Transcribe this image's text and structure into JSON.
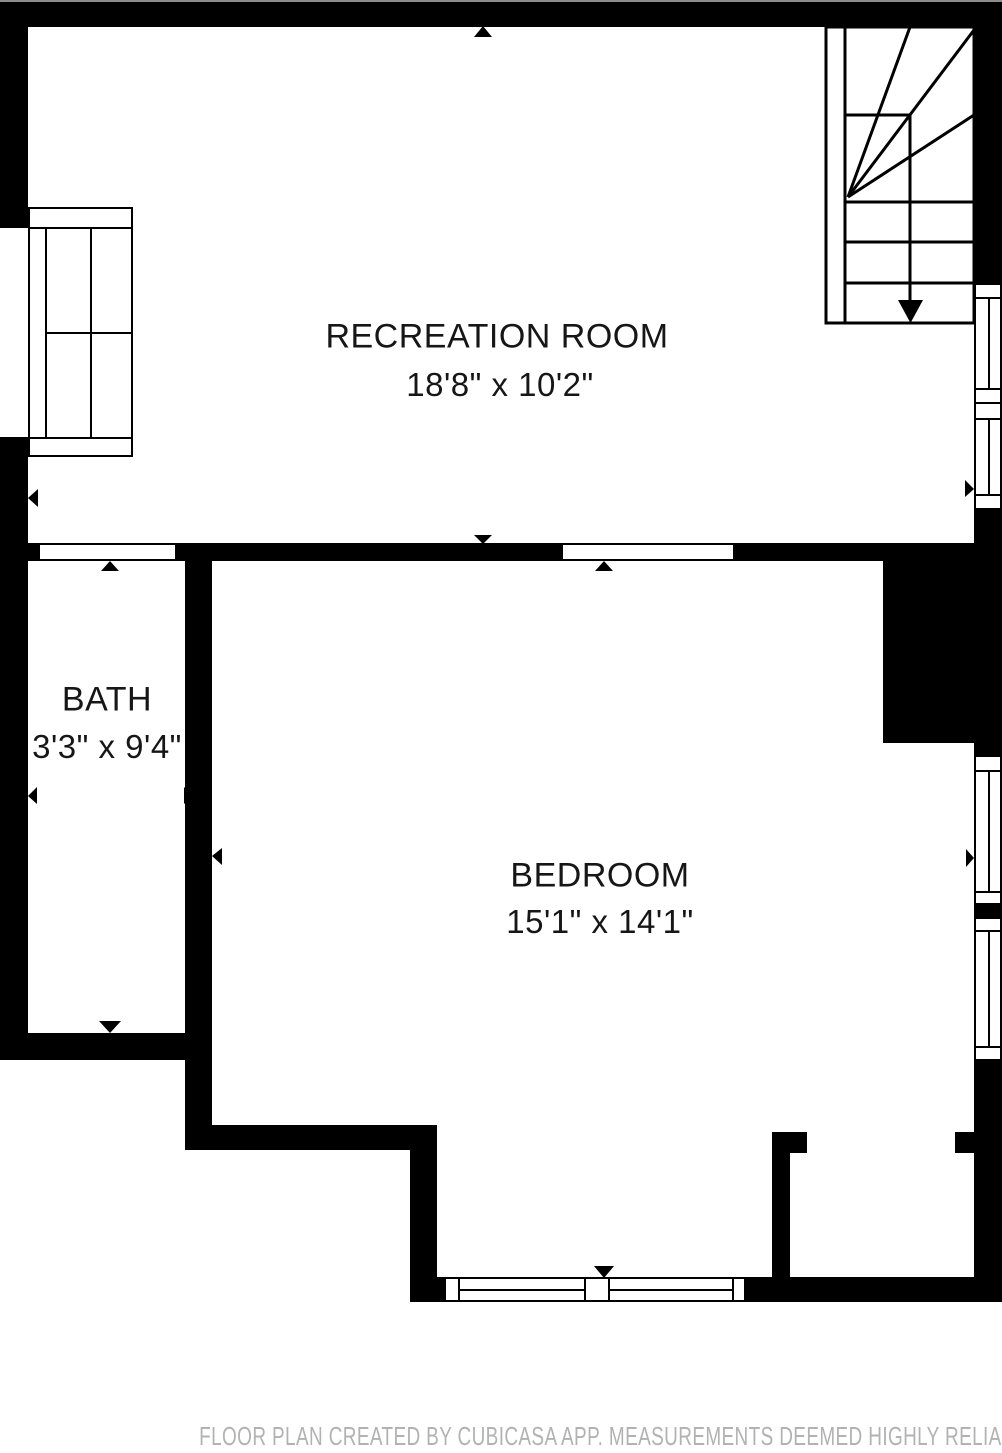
{
  "rooms": [
    {
      "name": "RECREATION ROOM",
      "dims": "18'8\" x 10'2\""
    },
    {
      "name": "BATH",
      "dims": "3'3\" x 9'4\""
    },
    {
      "name": "BEDROOM",
      "dims": "15'1\" x 14'1\""
    }
  ],
  "footer": {
    "disclaimer": "FLOOR PLAN CREATED BY CUBICASA APP. MEASUREMENTS DEEMED HIGHLY RELIABLE BUT NOT GUARANTEED."
  },
  "colors": {
    "wall": "#000000",
    "floor": "#ffffff",
    "label_text": "#161616",
    "footer_text": "#b2b2b2",
    "top_edge_line": "#8c8c8c"
  },
  "icons": {
    "door-marker": "small black triangle on wall opening",
    "stair-direction-arrow": "large black triangle pointing down"
  }
}
